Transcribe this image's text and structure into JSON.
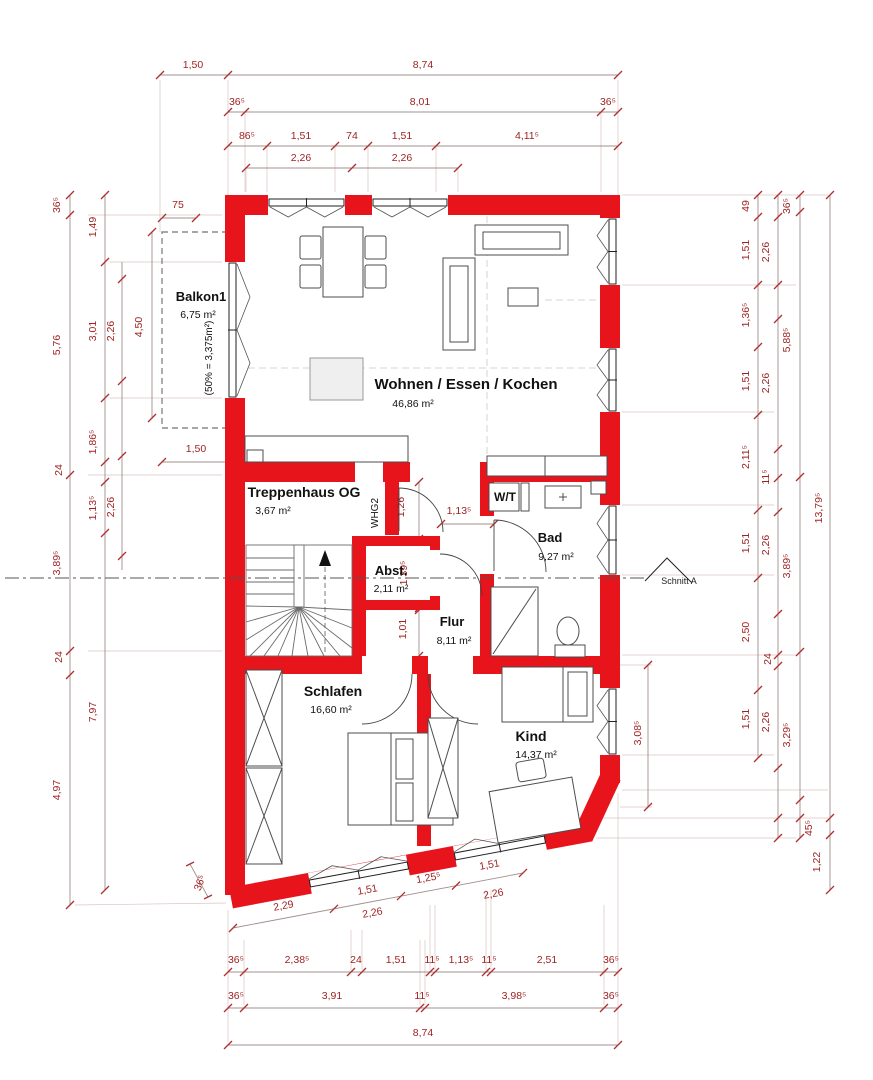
{
  "colors": {
    "wall": "#e8141c",
    "dim_text": "#9e2222",
    "tick": "#b03030",
    "chain_line": "#a0908c",
    "label_text": "#111111"
  },
  "rooms": {
    "balkon": {
      "name": "Balkon1",
      "area": "6,75 m²",
      "note": "(50% = 3,375m²)"
    },
    "wohnen": {
      "name": "Wohnen / Essen / Kochen",
      "area": "46,86 m²"
    },
    "treppenhaus": {
      "name": "Treppenhaus OG",
      "area": "3,67 m²"
    },
    "abst": {
      "name": "Abst.",
      "area": "2,11 m²"
    },
    "flur": {
      "name": "Flur",
      "area": "8,11 m²"
    },
    "wt": {
      "name": "W/T"
    },
    "bad": {
      "name": "Bad",
      "area": "9,27 m²"
    },
    "schlafen": {
      "name": "Schlafen",
      "area": "16,60 m²"
    },
    "kind": {
      "name": "Kind",
      "area": "14,37 m²"
    }
  },
  "labels": {
    "section": "Schnitt A",
    "door": "WHG2"
  },
  "dims": {
    "top": {
      "row1": [
        "1,50",
        "8,74"
      ],
      "row2": [
        "36⁵",
        "8,01",
        "36⁵"
      ],
      "row3": [
        "86⁵",
        "1,51",
        "74",
        "1,51",
        "4,11⁵"
      ],
      "row4": [
        "2,26",
        "2,26"
      ]
    },
    "left": {
      "outer": [
        "36⁵",
        "5,76",
        "3,89⁵",
        "4,97"
      ],
      "mid": [
        "1,49",
        "3,01",
        "1,86⁵",
        "1,13⁵",
        "7,97"
      ],
      "small": [
        "24",
        "24"
      ],
      "inner": [
        "2,26",
        "2,26"
      ],
      "balkon": [
        "75",
        "4,50",
        "1,50"
      ]
    },
    "right": {
      "rooms": [
        "49",
        "1,51",
        "1,36⁵",
        "1,51",
        "2,11⁵",
        "1,51",
        "2,50",
        "1,51"
      ],
      "openings": [
        "2,26",
        "2,26",
        "11⁵",
        "2,26",
        "24",
        "2,26"
      ],
      "walls": [
        "36⁵",
        "5,88⁵",
        "3,89⁵",
        "3,29⁵",
        "45⁵"
      ],
      "extra": [
        "1,22"
      ],
      "total": "13,79⁵",
      "kind_window": "3,08⁵"
    },
    "bottom": {
      "slant": [
        "2,29",
        "1,51",
        "1,25⁵",
        "1,51"
      ],
      "slant2": [
        "2,26",
        "2,26"
      ],
      "row1": [
        "36⁵",
        "2,38⁵",
        "24",
        "1,51",
        "11⁵",
        "1,13⁵",
        "11⁵",
        "2,51",
        "36⁵"
      ],
      "row2": [
        "36⁵",
        "3,91",
        "11⁵",
        "3,98⁵",
        "36⁵"
      ],
      "total": "8,74",
      "corner": "36⁵"
    },
    "interior": [
      "1,26",
      "1,13⁵",
      "1,39⁵",
      "1,01"
    ]
  }
}
